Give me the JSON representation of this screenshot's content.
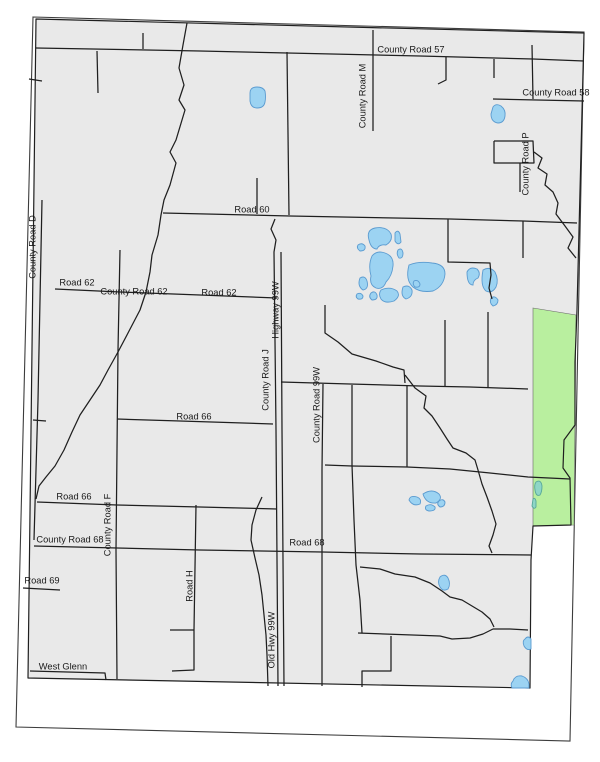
{
  "map": {
    "colors": {
      "background": "#ffffff",
      "county_fill": "#e9e9e9",
      "county_stroke": "#1f1f1f",
      "neatline_stroke": "#3c3c3c",
      "road_color": "#1f1f1f",
      "water_fill": "#9cd3f2",
      "water_stroke": "#5b9bd0",
      "teal_water_fill": "#8fd6c6",
      "teal_water_stroke": "#58a89a",
      "green_fill": "#b9ef9f",
      "green_stroke": "#6a6a6a",
      "label_color": "#1a1a1a"
    },
    "frame": {
      "neatline": [
        [
          33,
          17
        ],
        [
          584,
          32
        ],
        [
          570,
          741
        ],
        [
          16,
          727
        ]
      ],
      "county": [
        [
          36,
          19
        ],
        [
          584,
          33
        ],
        [
          577,
          310
        ],
        [
          575,
          362
        ],
        [
          575,
          425
        ],
        [
          564,
          440
        ],
        [
          563,
          468
        ],
        [
          570,
          478
        ],
        [
          571,
          525
        ],
        [
          533,
          526
        ],
        [
          531,
          560
        ],
        [
          530,
          688
        ],
        [
          28,
          678
        ]
      ],
      "green_area": [
        [
          533,
          308
        ],
        [
          576,
          315
        ],
        [
          574,
          525
        ],
        [
          533,
          526
        ]
      ]
    },
    "roads": [
      [
        [
          36,
          48
        ],
        [
          200,
          51
        ],
        [
          420,
          56
        ],
        [
          533,
          59
        ],
        [
          584,
          61
        ]
      ],
      [
        [
          143,
          33
        ],
        [
          143,
          49
        ]
      ],
      [
        [
          97,
          51
        ],
        [
          98,
          93
        ]
      ],
      [
        [
          446,
          57
        ],
        [
          446,
          80
        ],
        [
          438,
          84
        ]
      ],
      [
        [
          494,
          59
        ],
        [
          494,
          78
        ]
      ],
      [
        [
          532,
          45
        ],
        [
          533,
          99
        ]
      ],
      [
        [
          493,
          99
        ],
        [
          584,
          101
        ]
      ],
      [
        [
          494,
          141
        ],
        [
          533,
          141
        ],
        [
          534,
          163
        ],
        [
          494,
          163
        ],
        [
          494,
          141
        ]
      ],
      [
        [
          520,
          163
        ],
        [
          520,
          192
        ]
      ],
      [
        [
          534,
          152
        ],
        [
          542,
          158
        ],
        [
          538,
          168
        ],
        [
          547,
          174
        ],
        [
          545,
          185
        ],
        [
          553,
          192
        ],
        [
          558,
          203
        ],
        [
          556,
          214
        ],
        [
          565,
          226
        ],
        [
          573,
          237
        ],
        [
          568,
          248
        ],
        [
          576,
          258
        ]
      ],
      [
        [
          373,
          30
        ],
        [
          373,
          131
        ]
      ],
      [
        [
          287,
          52
        ],
        [
          289,
          215
        ]
      ],
      [
        [
          163,
          213
        ],
        [
          290,
          216
        ],
        [
          450,
          219
        ],
        [
          523,
          221
        ],
        [
          577,
          223
        ]
      ],
      [
        [
          257,
          178
        ],
        [
          257,
          214
        ]
      ],
      [
        [
          275,
          219
        ],
        [
          271,
          229
        ],
        [
          276,
          240
        ],
        [
          274,
          252
        ],
        [
          276,
          430
        ],
        [
          277,
          560
        ],
        [
          278,
          686
        ]
      ],
      [
        [
          281,
          252
        ],
        [
          282,
          430
        ],
        [
          283,
          560
        ],
        [
          284,
          686
        ]
      ],
      [
        [
          325,
          305
        ],
        [
          325,
          333
        ],
        [
          338,
          342
        ],
        [
          352,
          354
        ],
        [
          376,
          361
        ],
        [
          393,
          367
        ],
        [
          404,
          370
        ],
        [
          405,
          383
        ]
      ],
      [
        [
          323,
          384
        ],
        [
          322,
          470
        ],
        [
          322,
          553
        ],
        [
          322,
          686
        ]
      ],
      [
        [
          281,
          382
        ],
        [
          350,
          384
        ],
        [
          420,
          386
        ],
        [
          470,
          387
        ],
        [
          528,
          389
        ]
      ],
      [
        [
          445,
          320
        ],
        [
          445,
          386
        ]
      ],
      [
        [
          488,
          312
        ],
        [
          488,
          387
        ]
      ],
      [
        [
          448,
          219
        ],
        [
          448,
          262
        ],
        [
          490,
          263
        ],
        [
          491,
          275
        ],
        [
          489,
          288
        ],
        [
          492,
          299
        ]
      ],
      [
        [
          523,
          221
        ],
        [
          523,
          258
        ]
      ],
      [
        [
          325,
          465
        ],
        [
          352,
          466
        ],
        [
          407,
          467
        ],
        [
          450,
          469
        ],
        [
          490,
          473
        ],
        [
          528,
          477
        ],
        [
          570,
          479
        ]
      ],
      [
        [
          352,
          385
        ],
        [
          352,
          465
        ],
        [
          354,
          520
        ],
        [
          356,
          565
        ],
        [
          360,
          600
        ],
        [
          362,
          633
        ]
      ],
      [
        [
          407,
          386
        ],
        [
          407,
          467
        ]
      ],
      [
        [
          405,
          375
        ],
        [
          415,
          388
        ],
        [
          426,
          396
        ],
        [
          424,
          408
        ],
        [
          432,
          416
        ],
        [
          440,
          428
        ],
        [
          447,
          439
        ],
        [
          453,
          448
        ],
        [
          466,
          453
        ],
        [
          475,
          460
        ],
        [
          478,
          470
        ],
        [
          482,
          484
        ],
        [
          487,
          497
        ],
        [
          492,
          511
        ],
        [
          496,
          524
        ],
        [
          493,
          535
        ],
        [
          489,
          546
        ],
        [
          492,
          553
        ]
      ],
      [
        [
          360,
          567
        ],
        [
          380,
          569
        ],
        [
          395,
          574
        ],
        [
          415,
          577
        ],
        [
          430,
          583
        ],
        [
          442,
          591
        ],
        [
          450,
          597
        ],
        [
          462,
          600
        ],
        [
          472,
          606
        ],
        [
          482,
          612
        ],
        [
          490,
          619
        ],
        [
          494,
          627
        ]
      ],
      [
        [
          55,
          289
        ],
        [
          120,
          292
        ],
        [
          200,
          295
        ],
        [
          277,
          298
        ]
      ],
      [
        [
          120,
          250
        ],
        [
          118,
          350
        ],
        [
          117,
          450
        ],
        [
          116,
          550
        ],
        [
          117,
          679
        ]
      ],
      [
        [
          117,
          419
        ],
        [
          180,
          421
        ],
        [
          273,
          424
        ]
      ],
      [
        [
          33,
          420
        ],
        [
          46,
          421
        ]
      ],
      [
        [
          37,
          502
        ],
        [
          117,
          505
        ],
        [
          200,
          507
        ],
        [
          277,
          509
        ]
      ],
      [
        [
          187,
          23
        ],
        [
          183,
          45
        ],
        [
          179,
          68
        ],
        [
          184,
          85
        ],
        [
          179,
          100
        ],
        [
          185,
          110
        ],
        [
          176,
          140
        ],
        [
          170,
          152
        ],
        [
          176,
          163
        ],
        [
          170,
          185
        ],
        [
          164,
          200
        ],
        [
          161,
          215
        ],
        [
          158,
          235
        ],
        [
          152,
          255
        ],
        [
          150,
          272
        ],
        [
          146,
          292
        ],
        [
          140,
          310
        ],
        [
          128,
          333
        ],
        [
          118,
          352
        ],
        [
          108,
          370
        ],
        [
          100,
          385
        ],
        [
          90,
          400
        ],
        [
          80,
          415
        ],
        [
          72,
          432
        ],
        [
          64,
          450
        ],
        [
          55,
          466
        ],
        [
          46,
          477
        ],
        [
          39,
          486
        ],
        [
          36,
          499
        ]
      ],
      [
        [
          34,
          546
        ],
        [
          117,
          548
        ],
        [
          200,
          550
        ],
        [
          322,
          552
        ],
        [
          420,
          554
        ],
        [
          531,
          555
        ]
      ],
      [
        [
          23,
          588
        ],
        [
          60,
          590
        ]
      ],
      [
        [
          196,
          505
        ],
        [
          194,
          630
        ],
        [
          194,
          670
        ],
        [
          172,
          671
        ]
      ],
      [
        [
          170,
          630
        ],
        [
          194,
          630
        ]
      ],
      [
        [
          30,
          671
        ],
        [
          105,
          673
        ],
        [
          106,
          680
        ]
      ],
      [
        [
          42,
          200
        ],
        [
          38,
          400
        ],
        [
          34,
          540
        ]
      ],
      [
        [
          29,
          79
        ],
        [
          42,
          81
        ]
      ],
      [
        [
          358,
          633
        ],
        [
          440,
          636
        ],
        [
          452,
          639
        ],
        [
          470,
          638
        ],
        [
          483,
          634
        ],
        [
          493,
          629
        ],
        [
          510,
          629
        ],
        [
          528,
          630
        ]
      ],
      [
        [
          391,
          636
        ],
        [
          391,
          671
        ],
        [
          362,
          671
        ],
        [
          362,
          687
        ]
      ],
      [
        [
          262,
          497
        ],
        [
          256,
          510
        ],
        [
          252,
          525
        ],
        [
          251,
          540
        ],
        [
          255,
          558
        ],
        [
          259,
          575
        ],
        [
          262,
          595
        ],
        [
          264,
          615
        ],
        [
          266,
          635
        ],
        [
          267,
          655
        ],
        [
          268,
          686
        ]
      ]
    ],
    "lakes": [
      {
        "d": "M250 93 Q250 87 257 87 Q263 87 265 91 Q266 97 265 102 Q264 108 257 108 Q251 108 250 101 Z"
      },
      {
        "d": "M493 107 Q496 103 501 106 Q506 110 505 116 Q504 123 498 123 Q491 122 491 114 Z"
      },
      {
        "d": "M369 240 Q366 230 375 228 Q387 226 391 234 Q393 241 386 245 Q379 244 377 249 Q371 249 369 240 Z"
      },
      {
        "d": "M395 233 Q398 229 400 234 L401 242 Q398 246 395 241 Z"
      },
      {
        "d": "M358 245 Q362 242 365 246 Q366 251 360 251 Q356 248 358 245 Z"
      },
      {
        "d": "M372 256 Q377 250 385 253 Q394 256 393 266 Q392 276 386 282 Q383 290 376 288 Q369 285 371 276 Q368 265 372 256 Z"
      },
      {
        "d": "M409 265 Q419 261 432 263 Q445 264 445 274 Q444 286 433 291 Q420 293 413 287 Q405 280 409 265 Z"
      },
      {
        "d": "M398 250 Q402 247 403 253 Q403 259 399 258 Q396 254 398 250 Z"
      },
      {
        "d": "M360 278 Q365 275 367 281 Q369 289 363 290 Q357 286 360 278 Z"
      },
      {
        "d": "M371 293 Q375 290 377 295 Q378 300 372 300 Q368 297 371 293 Z"
      },
      {
        "d": "M381 290 Q390 286 397 291 Q401 296 394 301 Q385 304 381 299 Q378 294 381 290 Z"
      },
      {
        "d": "M403 287 Q409 284 412 290 Q413 297 406 299 Q400 296 403 287 Z"
      },
      {
        "d": "M357 294 Q361 292 363 296 Q363 300 358 299 Q355 297 357 294 Z"
      },
      {
        "d": "M414 281 Q418 279 420 284 Q420 288 415 287 Q412 284 414 281 Z"
      },
      {
        "d": "M467 272 Q470 266 477 269 Q481 273 478 278 Q473 280 473 285 Q467 285 467 272 Z"
      },
      {
        "d": "M483 270 Q490 266 495 272 Q499 280 496 287 Q492 294 486 291 Q480 286 483 270 Z"
      },
      {
        "d": "M491 298 Q495 295 498 300 Q498 305 493 306 Q489 303 491 298 Z"
      },
      {
        "d": "M409 500 Q410 495 417 497 Q422 499 420 504 Q413 507 409 500 Z"
      },
      {
        "d": "M423 494 Q432 488 439 494 Q443 499 436 503 Q426 504 423 494 Z"
      },
      {
        "d": "M426 506 Q431 503 435 507 Q436 511 429 511 Q424 510 426 506 Z"
      },
      {
        "d": "M439 501 Q443 498 445 502 Q445 507 440 507 Q436 504 439 501 Z"
      },
      {
        "d": "M440 577 Q445 573 448 578 Q451 584 448 589 Q443 592 440 587 Q437 582 440 577 Z"
      },
      {
        "d": "M525 639 Q528 635 531 639 L531 649 Q527 651 524 646 Q522 641 525 639 Z"
      },
      {
        "d": "M513 681 Q515 675 522 676 Q528 678 529 684 L529 688 L512 688 Q510 684 513 681 Z"
      },
      {
        "d": "M536 482 Q541 479 542 486 Q542 492 540 495 Q536 497 535 490 Q534 485 536 482 Z",
        "teal": true
      },
      {
        "d": "M533 499 Q535 497 536 501 L536 507 Q534 510 532 506 Z",
        "teal": true
      }
    ],
    "labels": [
      {
        "text": "County Road 57",
        "x": 411,
        "y": 50,
        "vertical": false
      },
      {
        "text": "County Road M",
        "x": 363,
        "y": 96,
        "vertical": true
      },
      {
        "text": "County Road 58",
        "x": 556,
        "y": 93,
        "vertical": false
      },
      {
        "text": "County Road P",
        "x": 526,
        "y": 164,
        "vertical": true
      },
      {
        "text": "Road 60",
        "x": 252,
        "y": 210,
        "vertical": false
      },
      {
        "text": "County Road D",
        "x": 33,
        "y": 247,
        "vertical": true
      },
      {
        "text": "Road 62",
        "x": 77,
        "y": 283,
        "vertical": false
      },
      {
        "text": "County Road 62",
        "x": 134,
        "y": 292,
        "vertical": false
      },
      {
        "text": "Road 62",
        "x": 219,
        "y": 293,
        "vertical": false
      },
      {
        "text": "Highway 99W",
        "x": 276,
        "y": 310,
        "vertical": true
      },
      {
        "text": "County Road J",
        "x": 266,
        "y": 380,
        "vertical": true
      },
      {
        "text": "County Road 99W",
        "x": 317,
        "y": 405,
        "vertical": true
      },
      {
        "text": "Road 66",
        "x": 194,
        "y": 417,
        "vertical": false
      },
      {
        "text": "Road 66",
        "x": 74,
        "y": 497,
        "vertical": false
      },
      {
        "text": "County Road F",
        "x": 108,
        "y": 525,
        "vertical": true
      },
      {
        "text": "County Road 68",
        "x": 70,
        "y": 540,
        "vertical": false
      },
      {
        "text": "Road 68",
        "x": 307,
        "y": 543,
        "vertical": false
      },
      {
        "text": "Road 69",
        "x": 42,
        "y": 581,
        "vertical": false
      },
      {
        "text": "Road H",
        "x": 190,
        "y": 586,
        "vertical": true
      },
      {
        "text": "Old Hwy 99W",
        "x": 272,
        "y": 640,
        "vertical": true
      },
      {
        "text": "West Glenn",
        "x": 63,
        "y": 667,
        "vertical": false
      }
    ]
  }
}
